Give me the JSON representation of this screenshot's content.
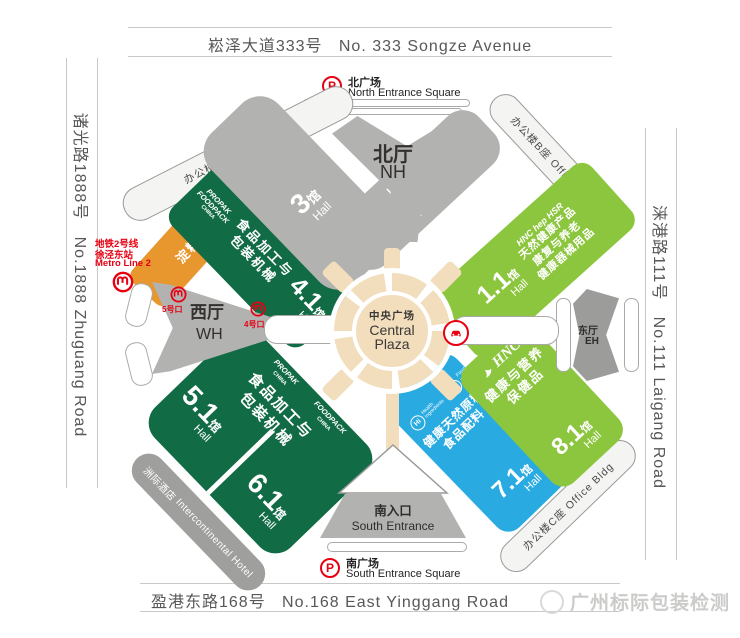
{
  "roads": {
    "north_zh": "崧泽大道333号",
    "north_en": "No. 333 Songze Avenue",
    "south_zh": "盈港东路168号",
    "south_en": "No.168 East Yinggang Road",
    "west_zh": "诸光路1888号",
    "west_en": "No.1888 Zhuguang Road",
    "east_zh": "涞港路111号",
    "east_en": "No.111 Laigang Road"
  },
  "entrances": {
    "parking_letter": "P",
    "north_square_zh": "北广场",
    "north_square_en": "North Entrance Square",
    "south_square_zh": "南广场",
    "south_square_en": "South Entrance Square",
    "south_gate_zh": "南入口",
    "south_gate_en": "South Entrance"
  },
  "metro": {
    "line_zh": "地铁2号线",
    "station_zh": "徐泾东站",
    "line_en": "Metro Line 2",
    "exit5": "5号口",
    "exit4": "4号口"
  },
  "lobbies": {
    "north_zh": "北厅",
    "north_en": "NH",
    "west_zh": "西厅",
    "west_en": "WH",
    "east_zh": "东厅",
    "east_en": "EH",
    "central_zh": "中央广场",
    "central_en1": "Central",
    "central_en2": "Plaza"
  },
  "buildings": {
    "office_a": "办公楼A座 Office Bldg",
    "office_b": "办公楼B座 Office Bldg",
    "office_c": "办公楼C座 Office Bldg",
    "hotel_zh": "洲际酒店",
    "hotel_en": "Intercontinental Hotel"
  },
  "halls": {
    "h3": {
      "num": "3",
      "unit": "馆",
      "hall": "Hall"
    },
    "h21": {
      "num": "2.1",
      "unit": "馆",
      "hall": "Hall"
    },
    "h41": {
      "num": "4.1",
      "unit": "馆",
      "hall": "Hall",
      "logo1": "PROPAK",
      "logo2": "FOODPACK",
      "logo3": "CHINA",
      "line1": "食品加工与",
      "line2": "包装机械"
    },
    "h56": {
      "num5": "5.1",
      "num6": "6.1",
      "unit": "馆",
      "hall": "Hall",
      "logo1a": "PROPAK",
      "logo1b": "CHINA",
      "logo2a": "FOODPACK",
      "logo2b": "CHINA",
      "line1": "食品加工与",
      "line2": "包装机械"
    },
    "h11": {
      "num": "1.1",
      "unit": "馆",
      "hall": "Hall",
      "logo": "HNC hep HSR",
      "line1": "天然健康产品",
      "line2": "康复与养老",
      "line3": "健康器械用品"
    },
    "h71": {
      "num": "7.1",
      "unit": "馆",
      "hall": "Hall",
      "logo1_abbr": "Hi",
      "logo1_text": "Health ingredients",
      "logo2_abbr": "Fi",
      "logo2_text": "Food ingredients Asia-China",
      "line1": "健康天然原料",
      "line2": "食品配料"
    },
    "h81": {
      "num": "8.1",
      "unit": "馆",
      "hall": "Hall",
      "logo": "HNC",
      "line1": "健康与营养",
      "line2": "保健品"
    },
    "orange": {
      "logo": "全球薯业",
      "line": "淀粉及薯业"
    }
  },
  "watermark": "广州标际包装检测",
  "colors": {
    "dark_green": "#116b45",
    "light_green": "#8cc63e",
    "blue": "#29abe2",
    "orange": "#e8962e",
    "gray_hall": "#b2b2b0",
    "red": "#e60012",
    "tan": "#f2debc"
  }
}
